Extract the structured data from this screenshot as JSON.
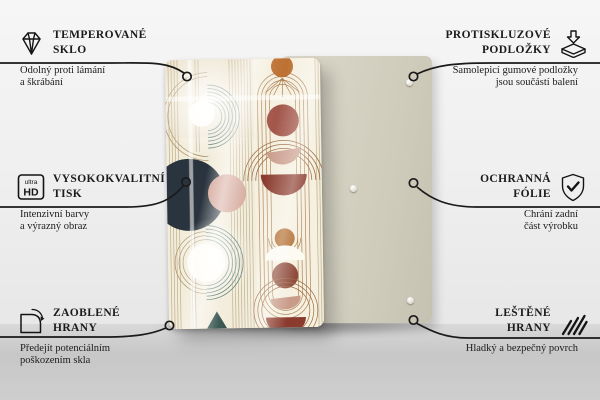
{
  "features": {
    "top_left": {
      "icon": "diamond-icon",
      "title_line1": "TEMPEROVANÉ",
      "title_line2": "SKLO",
      "subtitle_line1": "Odolný proti lámání",
      "subtitle_line2": "a škrábání"
    },
    "middle_left": {
      "icon": "ultra-hd-icon",
      "title_line1": "VYSOKOKVALITNÍ",
      "title_line2": "TISK",
      "subtitle_line1": "Intenzivní barvy",
      "subtitle_line2": "a výrazný obraz",
      "icon_text_line1": "ultra",
      "icon_text_line2": "HD"
    },
    "bottom_left": {
      "icon": "rounded-corner-icon",
      "title_line1": "ZAOBLENÉ",
      "title_line2": "HRANY",
      "subtitle_line1": "Předejít potenciálním",
      "subtitle_line2": "poškozením skla"
    },
    "top_right": {
      "icon": "anti-slip-pads-icon",
      "title_line1": "PROTISKLUZOVÉ",
      "title_line2": "PODLOŽKY",
      "subtitle_line1": "Samolepicí gumové podložky",
      "subtitle_line2": "jsou součástí balení"
    },
    "middle_right": {
      "icon": "shield-check-icon",
      "title_line1": "OCHRANNÁ",
      "title_line2": "FÓLIE",
      "subtitle_line1": "Chrání zadní",
      "subtitle_line2": "část výrobku"
    },
    "bottom_right": {
      "icon": "polished-edges-icon",
      "title_line1": "LEŠTĚNÉ",
      "title_line2": "HRANY",
      "subtitle_line1": "Hladký a bezpečný povrch",
      "subtitle_line2": ""
    }
  },
  "colors": {
    "text": "#1b1b1b",
    "callout_line": "#1a1a1a",
    "front_panel_bg": "#f2ecda",
    "back_panel_bg": "#d5d2c3",
    "navy_circle": "#2a343e",
    "terracotta": "#a3564a",
    "dark_red": "#8b3b2d",
    "dusty_pink": "#d6aa9d",
    "orange": "#bd7031",
    "teal_arcs": "#47706a",
    "brown_lines": "#a4713f"
  }
}
